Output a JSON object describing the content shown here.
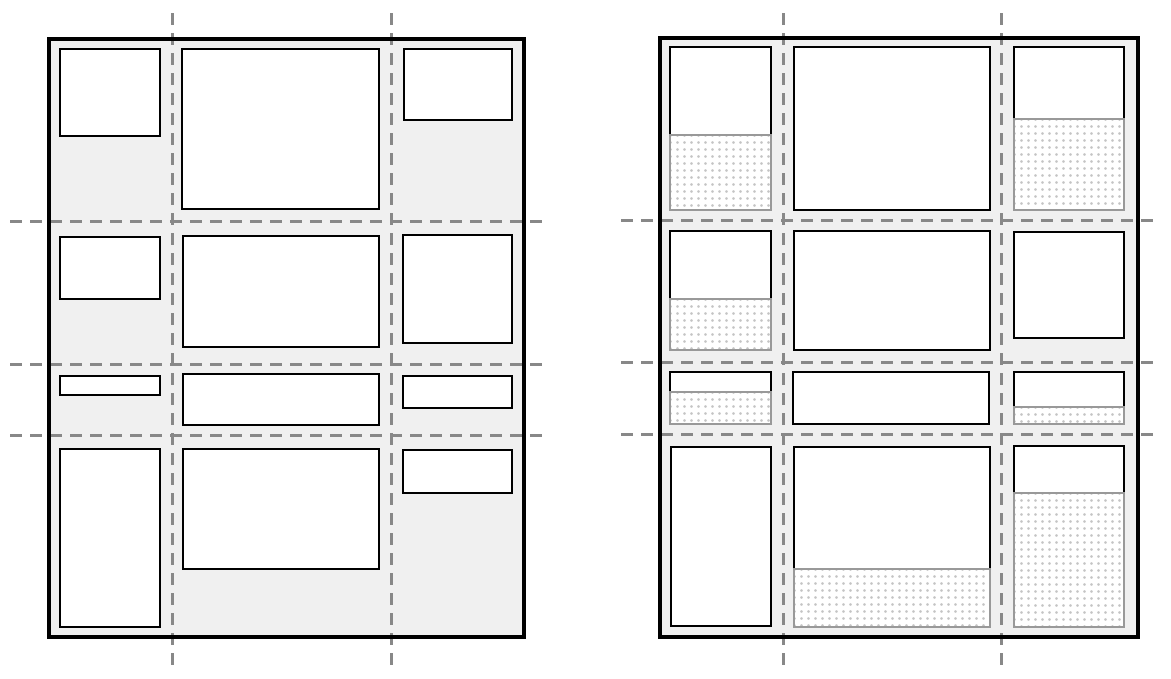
{
  "canvas": {
    "width": 1171,
    "height": 679,
    "background": "#ffffff"
  },
  "style": {
    "container_fill": "#f0f0f0",
    "container_border_color": "#000000",
    "container_border_width": 4,
    "item_fill": "#ffffff",
    "item_border_color": "#000000",
    "item_border_width": 2.5,
    "stretch_fill": "#ffffff",
    "stretch_border_color": "#999999",
    "stretch_border_width": 2.5,
    "stretch_dot_color": "#c4c4c4",
    "stretch_dot_size": 1.2,
    "stretch_dot_spacing": 7,
    "gridline_color": "#888888",
    "gridline_width": 3,
    "dash_length": 12,
    "dash_gap": 8
  },
  "figures": [
    {
      "id": "left-grid",
      "container": {
        "x": 47,
        "y": 37,
        "w": 479,
        "h": 602
      },
      "vlines": [
        {
          "x": 172,
          "y1": 13,
          "y2": 672
        },
        {
          "x": 391,
          "y1": 13,
          "y2": 672
        }
      ],
      "hlines": [
        {
          "y": 221,
          "x1": 10,
          "x2": 547
        },
        {
          "y": 364,
          "x1": 10,
          "x2": 547
        },
        {
          "y": 435,
          "x1": 10,
          "x2": 547
        }
      ],
      "items": [
        {
          "row": 1,
          "col": 1,
          "x": 59,
          "y": 48,
          "w": 102,
          "content_h": 89,
          "stretch_h": 0
        },
        {
          "row": 1,
          "col": 2,
          "x": 181,
          "y": 48,
          "w": 199,
          "content_h": 162,
          "stretch_h": 0
        },
        {
          "row": 1,
          "col": 3,
          "x": 403,
          "y": 48,
          "w": 110,
          "content_h": 73,
          "stretch_h": 0
        },
        {
          "row": 2,
          "col": 1,
          "x": 59,
          "y": 236,
          "w": 102,
          "content_h": 64,
          "stretch_h": 0
        },
        {
          "row": 2,
          "col": 2,
          "x": 182,
          "y": 235,
          "w": 198,
          "content_h": 113,
          "stretch_h": 0
        },
        {
          "row": 2,
          "col": 3,
          "x": 402,
          "y": 234,
          "w": 111,
          "content_h": 110,
          "stretch_h": 0
        },
        {
          "row": 3,
          "col": 1,
          "x": 59,
          "y": 375,
          "w": 102,
          "content_h": 21,
          "stretch_h": 0
        },
        {
          "row": 3,
          "col": 2,
          "x": 182,
          "y": 373,
          "w": 198,
          "content_h": 53,
          "stretch_h": 0
        },
        {
          "row": 3,
          "col": 3,
          "x": 402,
          "y": 375,
          "w": 111,
          "content_h": 34,
          "stretch_h": 0
        },
        {
          "row": 4,
          "col": 1,
          "x": 59,
          "y": 448,
          "w": 102,
          "content_h": 180,
          "stretch_h": 0
        },
        {
          "row": 4,
          "col": 2,
          "x": 182,
          "y": 448,
          "w": 198,
          "content_h": 122,
          "stretch_h": 0
        },
        {
          "row": 4,
          "col": 3,
          "x": 402,
          "y": 449,
          "w": 111,
          "content_h": 45,
          "stretch_h": 0
        }
      ]
    },
    {
      "id": "right-grid",
      "container": {
        "x": 658,
        "y": 36,
        "w": 482,
        "h": 603
      },
      "vlines": [
        {
          "x": 783,
          "y1": 13,
          "y2": 672
        },
        {
          "x": 1001,
          "y1": 13,
          "y2": 672
        }
      ],
      "hlines": [
        {
          "y": 220,
          "x1": 621,
          "x2": 1159
        },
        {
          "y": 362,
          "x1": 621,
          "x2": 1159
        },
        {
          "y": 434,
          "x1": 621,
          "x2": 1159
        }
      ],
      "items": [
        {
          "row": 1,
          "col": 1,
          "x": 669,
          "y": 46,
          "w": 103,
          "content_h": 88,
          "stretch_h": 77
        },
        {
          "row": 1,
          "col": 2,
          "x": 793,
          "y": 46,
          "w": 198,
          "content_h": 165,
          "stretch_h": 0
        },
        {
          "row": 1,
          "col": 3,
          "x": 1013,
          "y": 46,
          "w": 112,
          "content_h": 72,
          "stretch_h": 93
        },
        {
          "row": 2,
          "col": 1,
          "x": 669,
          "y": 230,
          "w": 103,
          "content_h": 68,
          "stretch_h": 53
        },
        {
          "row": 2,
          "col": 2,
          "x": 793,
          "y": 230,
          "w": 198,
          "content_h": 121,
          "stretch_h": 0
        },
        {
          "row": 2,
          "col": 3,
          "x": 1013,
          "y": 231,
          "w": 112,
          "content_h": 108,
          "stretch_h": 0
        },
        {
          "row": 3,
          "col": 1,
          "x": 669,
          "y": 371,
          "w": 103,
          "content_h": 20,
          "stretch_h": 34
        },
        {
          "row": 3,
          "col": 2,
          "x": 792,
          "y": 371,
          "w": 198,
          "content_h": 54,
          "stretch_h": 0
        },
        {
          "row": 3,
          "col": 3,
          "x": 1013,
          "y": 371,
          "w": 112,
          "content_h": 35,
          "stretch_h": 19
        },
        {
          "row": 4,
          "col": 1,
          "x": 670,
          "y": 446,
          "w": 102,
          "content_h": 181,
          "stretch_h": 0
        },
        {
          "row": 4,
          "col": 2,
          "x": 793,
          "y": 446,
          "w": 198,
          "content_h": 122,
          "stretch_h": 60
        },
        {
          "row": 4,
          "col": 3,
          "x": 1013,
          "y": 445,
          "w": 112,
          "content_h": 47,
          "stretch_h": 136
        }
      ]
    }
  ]
}
